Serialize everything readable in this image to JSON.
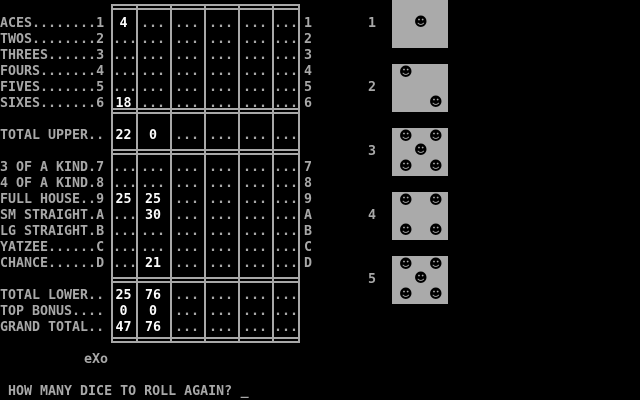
{
  "colors": {
    "background": "#000000",
    "text_gray": "#A8A8A8",
    "value_white": "#FCFCFC",
    "die_gray": "#AAAAAA",
    "pip_black": "#000000"
  },
  "scorecard": {
    "empty_cell": "...",
    "rows": [
      {
        "id": "aces",
        "label": "ACES........1",
        "right": "1",
        "cells": [
          "4",
          null,
          null,
          null,
          null,
          null
        ]
      },
      {
        "id": "twos",
        "label": "TWOS........2",
        "right": "2",
        "cells": [
          null,
          null,
          null,
          null,
          null,
          null
        ]
      },
      {
        "id": "threes",
        "label": "THREES......3",
        "right": "3",
        "cells": [
          null,
          null,
          null,
          null,
          null,
          null
        ]
      },
      {
        "id": "fours",
        "label": "FOURS.......4",
        "right": "4",
        "cells": [
          null,
          null,
          null,
          null,
          null,
          null
        ]
      },
      {
        "id": "fives",
        "label": "FIVES.......5",
        "right": "5",
        "cells": [
          null,
          null,
          null,
          null,
          null,
          null
        ]
      },
      {
        "id": "sixes",
        "label": "SIXES.......6",
        "right": "6",
        "cells": [
          "18",
          null,
          null,
          null,
          null,
          null
        ]
      },
      {
        "id": "total-upper",
        "label": "TOTAL UPPER..",
        "right": "",
        "cells": [
          "22",
          "0",
          null,
          null,
          null,
          null
        ]
      },
      {
        "id": "three-of-a-kind",
        "label": "3 OF A KIND.7",
        "right": "7",
        "cells": [
          null,
          null,
          null,
          null,
          null,
          null
        ]
      },
      {
        "id": "four-of-a-kind",
        "label": "4 OF A KIND.8",
        "right": "8",
        "cells": [
          null,
          null,
          null,
          null,
          null,
          null
        ]
      },
      {
        "id": "full-house",
        "label": "FULL HOUSE..9",
        "right": "9",
        "cells": [
          "25",
          "25",
          null,
          null,
          null,
          null
        ]
      },
      {
        "id": "sm-straight",
        "label": "SM STRAIGHT.A",
        "right": "A",
        "cells": [
          null,
          "30",
          null,
          null,
          null,
          null
        ]
      },
      {
        "id": "lg-straight",
        "label": "LG STRAIGHT.B",
        "right": "B",
        "cells": [
          null,
          null,
          null,
          null,
          null,
          null
        ]
      },
      {
        "id": "yatzee",
        "label": "YATZEE......C",
        "right": "C",
        "cells": [
          null,
          null,
          null,
          null,
          null,
          null
        ]
      },
      {
        "id": "chance",
        "label": "CHANCE......D",
        "right": "D",
        "cells": [
          null,
          "21",
          null,
          null,
          null,
          null
        ]
      },
      {
        "id": "total-lower",
        "label": "TOTAL LOWER..",
        "right": "",
        "cells": [
          "25",
          "76",
          null,
          null,
          null,
          null
        ]
      },
      {
        "id": "top-bonus",
        "label": "TOP BONUS....",
        "right": "",
        "cells": [
          "0",
          "0",
          null,
          null,
          null,
          null
        ]
      },
      {
        "id": "grand-total",
        "label": "GRAND TOTAL..",
        "right": "",
        "cells": [
          "47",
          "76",
          null,
          null,
          null,
          null
        ]
      }
    ]
  },
  "dice": {
    "pip_glyph": "☻",
    "items": [
      {
        "label": "1",
        "value": 1
      },
      {
        "label": "2",
        "value": 2
      },
      {
        "label": "3",
        "value": 5
      },
      {
        "label": "4",
        "value": 4
      },
      {
        "label": "5",
        "value": 5
      }
    ]
  },
  "watermark": "eXo",
  "prompt": {
    "text": "HOW MANY DICE TO ROLL AGAIN?",
    "cursor": "_"
  }
}
